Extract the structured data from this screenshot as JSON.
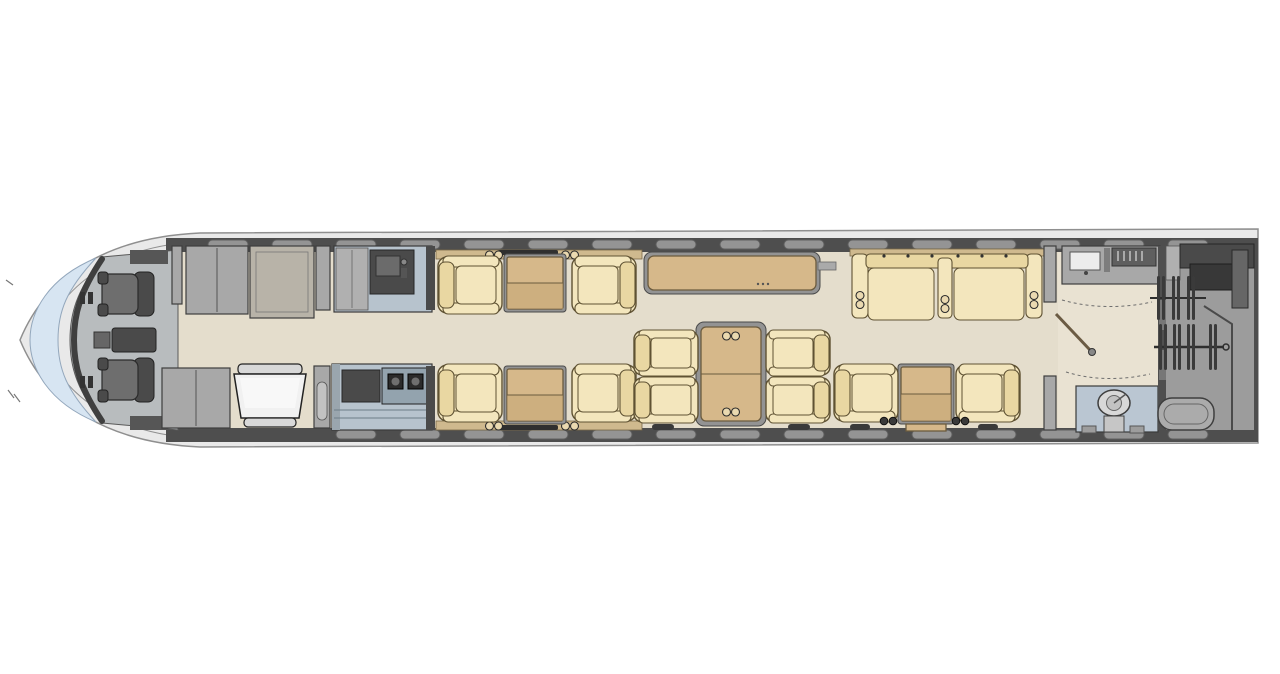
{
  "meta": {
    "subject": "private-jet-cabin-floorplan",
    "view": "top-down-plan",
    "orientation": "nose-left",
    "visible_text": "none"
  },
  "palette": {
    "bg": "#ffffff",
    "wall": "#4e4e4e",
    "floor": "#e4ddcc",
    "cockpit-floor": "#b8bcbe",
    "windscreen": "#d7e5f2",
    "seat": "#f3e6bd",
    "seat-shade": "#e9d7a2",
    "seat-line": "#5f5233",
    "table": "#d6b88a",
    "table-dark": "#c6a876",
    "table-line": "#6b5b3e",
    "cabinet": "#a8a8a8",
    "counter": "#b7c3cd",
    "window": "#949494",
    "crew-seat": "#6e6e6e",
    "toilet-panel": "#bac6d2",
    "baggage-floor": "#9c9c9c"
  },
  "inventory": {
    "crew_seats": 2,
    "forward_club_seats": 4,
    "conference_dining_seats": 4,
    "divan_cushions": 2,
    "aft_club_seats": 2,
    "forward_side_tables": 2,
    "conference_table": 1,
    "aft_side_table": 1,
    "credenza": 1,
    "galley_units": 2,
    "lavatories": 1,
    "entry_airstair_doors": 1,
    "baggage_compartments": 1,
    "wardrobe_hanger_rods": 2,
    "cabin_windows_top": 16,
    "cabin_windows_bottom": 14
  },
  "zones": [
    {
      "id": "cockpit-zone",
      "label": "cockpit"
    },
    {
      "id": "entry-zone",
      "label": "entry-vestibule"
    },
    {
      "id": "galley-zone",
      "label": "galley"
    },
    {
      "id": "forward-club-zone",
      "label": "forward-club-seating"
    },
    {
      "id": "credenza-zone",
      "label": "credenza"
    },
    {
      "id": "conference-zone",
      "label": "conference-dining-group"
    },
    {
      "id": "divan-zone",
      "label": "three-place-divan"
    },
    {
      "id": "aft-club-zone",
      "label": "aft-club-seating"
    },
    {
      "id": "lavatory-zone",
      "label": "aft-lavatory"
    },
    {
      "id": "baggage-zone",
      "label": "baggage-wardrobe-compartment"
    }
  ]
}
